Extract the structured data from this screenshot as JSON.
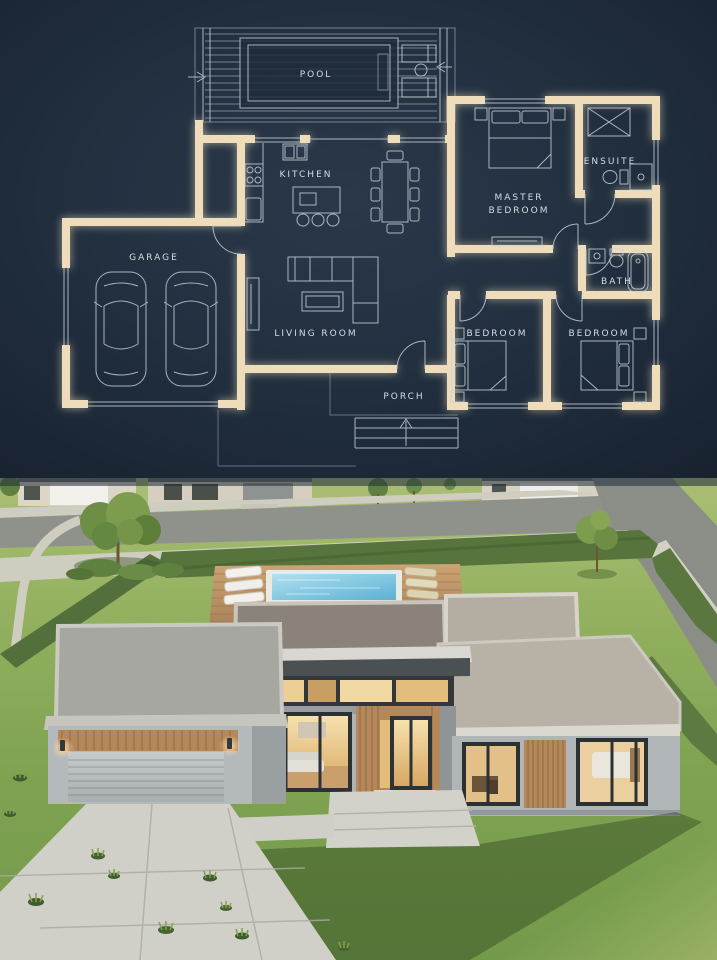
{
  "floor_plan": {
    "labels": {
      "pool": "POOL",
      "kitchen": "KITCHEN",
      "master_line1": "MASTER",
      "master_line2": "BEDROOM",
      "ensuite": "ENSUITE",
      "garage": "GARAGE",
      "living_room": "LIVING ROOM",
      "bath": "BATH",
      "bedroom_left": "BEDROOM",
      "bedroom_right": "BEDROOM",
      "porch": "PORCH"
    },
    "colors": {
      "background": "#1e2a38",
      "wall": "#eedcba",
      "line": "#c9d3dc",
      "label": "#d4dde5"
    }
  },
  "render": {
    "colors": {
      "grass_sunlit": "#9cb964",
      "grass_mid": "#85a754",
      "grass_shadow": "#426030",
      "hedge": "#5a7a3e",
      "road": "#8f928b",
      "sidewalk": "#cfccc0",
      "driveway_concrete": "#d0d0c8",
      "house_wall": "#b7bcbe",
      "roof_dark": "#8b867d",
      "roof_light": "#b5afa4",
      "wood_slats": "#b5885a",
      "window_glow": "#ecd09c",
      "pool_water": "#7cc4e0",
      "pool_coping": "#e9eae2"
    }
  }
}
